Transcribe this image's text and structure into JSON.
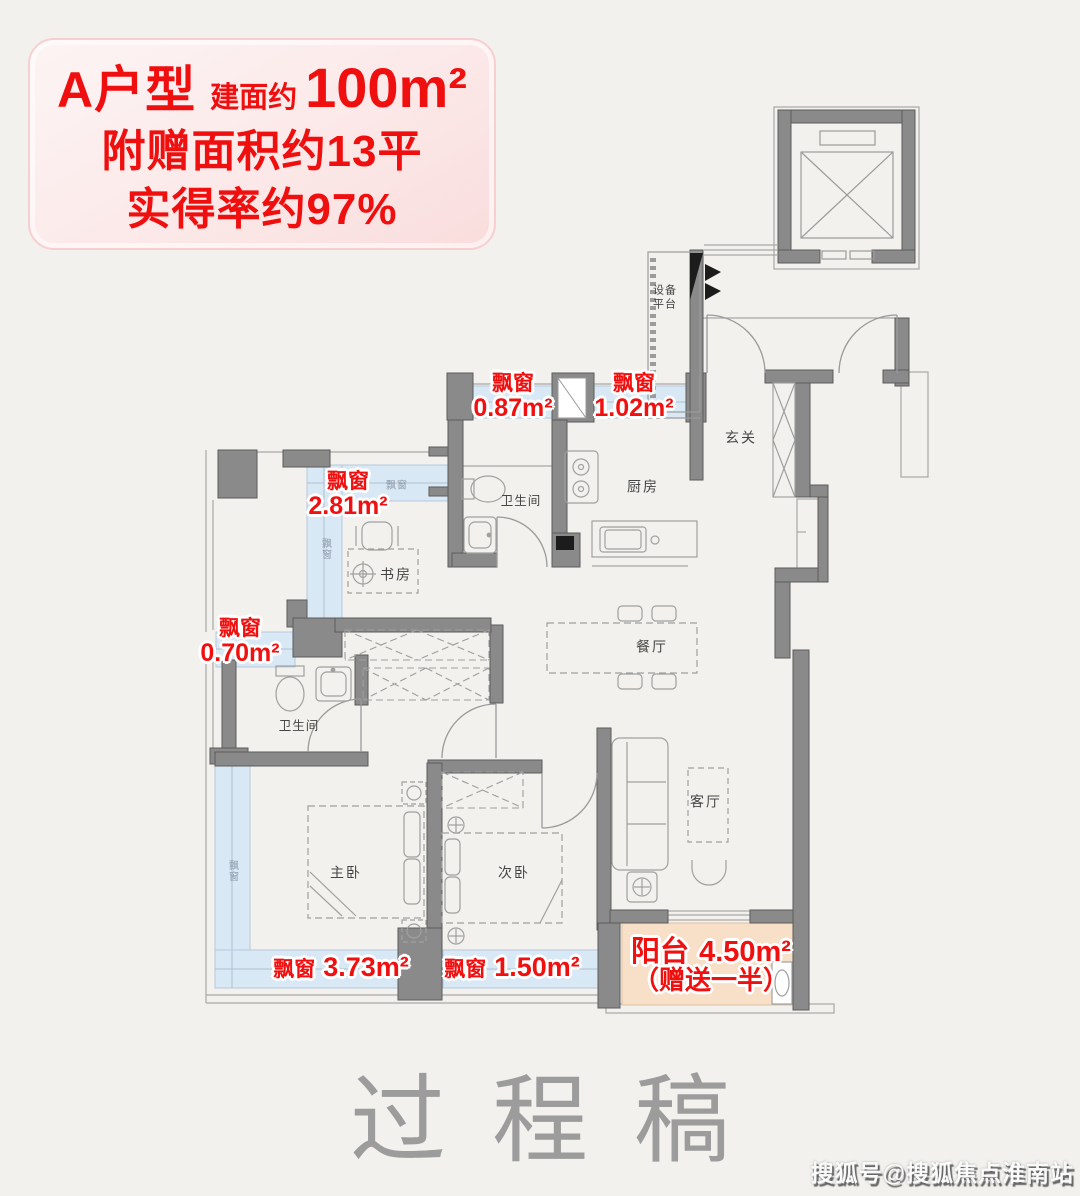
{
  "header": {
    "unit_name": "A户型",
    "area_prefix": "建面约",
    "area_value": "100m²",
    "bonus_line": "附赠面积约13平",
    "efficiency_line": "实得率约97%"
  },
  "plan": {
    "rooms": {
      "equipment_line1": "设备",
      "equipment_line2": "平台",
      "entry": "玄关",
      "kitchen": "厨房",
      "bathroom_upper": "卫生间",
      "study": "书房",
      "bathroom_lower": "卫生间",
      "dining": "餐厅",
      "living": "客厅",
      "master_bedroom": "主卧",
      "second_bedroom": "次卧"
    },
    "bay_window_label": "飘窗",
    "window_mark": "飘窗",
    "bay_windows": {
      "bath_upper": "0.87m²",
      "kitchen": "1.02m²",
      "study": "2.81m²",
      "hall": "0.70m²",
      "master": "3.73m²",
      "second": "1.50m²"
    },
    "balcony": {
      "name": "阳台",
      "area": "4.50m²",
      "note": "（赠送一半）"
    }
  },
  "watermark": "过程稿",
  "credit": "搜狐号@搜狐焦点淮南站",
  "colors": {
    "accent_red": "#f01010",
    "bay_window_fill": "#d9e8f5",
    "balcony_fill": "#f7dfc8",
    "wall_gray": "#8a8a8a",
    "background": "#f2f1ee"
  }
}
